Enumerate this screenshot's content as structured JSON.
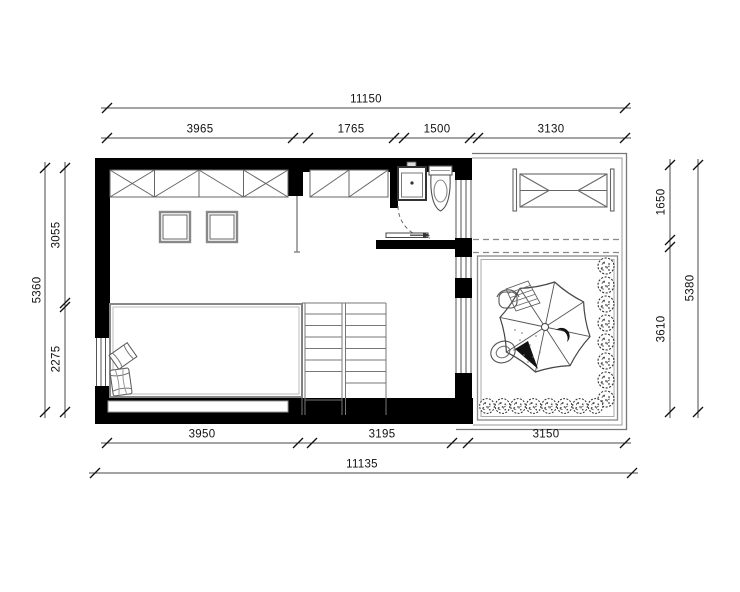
{
  "dimensions": {
    "top": {
      "overall": "11150",
      "segments": [
        "3965",
        "1765",
        "1500",
        "3130"
      ]
    },
    "bottom": {
      "overall": "11135",
      "segments": [
        "3950",
        "3195",
        "3150"
      ]
    },
    "left": {
      "overall": "5360",
      "segments": [
        "3055",
        "2275"
      ]
    },
    "right": {
      "overall": "5380",
      "segments": [
        "1650",
        "3610"
      ]
    }
  },
  "colors": {
    "wall": "#000000",
    "outline": "#555555",
    "dimension_line": "#4a4a4a",
    "dimension_text": "#111111",
    "background": "#ffffff"
  },
  "fixture_icons": [
    "wardrobe-icon",
    "closet-icon",
    "sink-icon",
    "toilet-icon",
    "door-swing-icon",
    "sliding-door-icon",
    "stairs-icon",
    "bed-platform-icon",
    "slippers-icon",
    "drying-rack-icon",
    "parasol-table-icon",
    "chair-icon",
    "shrub-icon",
    "window-icon"
  ]
}
